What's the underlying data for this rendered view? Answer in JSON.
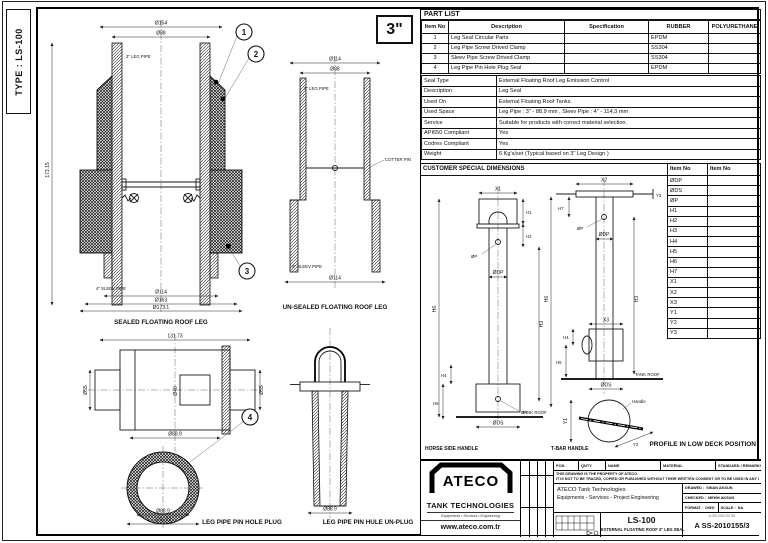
{
  "sheet": {
    "type_label": "TYPE : LS-100",
    "size_badge": "3\""
  },
  "part_list": {
    "title": "PART LIST",
    "headers": [
      "Item No",
      "Description",
      "Specification",
      "RUBBER",
      "POLYURETHANE"
    ],
    "rows": [
      {
        "no": "1",
        "desc": "Leg Seal Circular Parts",
        "spec": "",
        "rubber": "EPDM",
        "poly": ""
      },
      {
        "no": "2",
        "desc": "Leg Pipe Screw Drived Clamp",
        "spec": "",
        "rubber": "SS304",
        "poly": ""
      },
      {
        "no": "3",
        "desc": "Sleev Pipe Screw Drived Clamp",
        "spec": "",
        "rubber": "SS304",
        "poly": ""
      },
      {
        "no": "4",
        "desc": "Leg Pipe Pin Hole Plug Seal",
        "spec": "",
        "rubber": "EPDM",
        "poly": ""
      }
    ]
  },
  "seal_info": [
    {
      "label": "Seal Type",
      "value": "External Floating Roof Leg Emission Control"
    },
    {
      "label": "Description",
      "value": "Leg Seal"
    },
    {
      "label": "Used On",
      "value": "External Floating Roof Tanks."
    },
    {
      "label": "Used Space",
      "value": "Leg Pipe : 3\" - 88,9 mm , Sleev Pipe : 4\" - 114,3 mm"
    },
    {
      "label": "Service",
      "value": "Suitable for products with correct material selection."
    },
    {
      "label": "API650 Compliant",
      "value": "Yes"
    },
    {
      "label": "Codres Compliant",
      "value": "Yes"
    },
    {
      "label": "Weight",
      "value": "6 Kg's/set (Typical based on 3\" Leg Design )"
    }
  ],
  "customer": {
    "title": "CUSTOMER SPECIAL DIMENSIONS",
    "header_left": "Item No",
    "header_right": "Item No",
    "rows": [
      "ØDP",
      "ØDS",
      "ØP",
      "H1",
      "H2",
      "H3",
      "H4",
      "H5",
      "H6",
      "H7",
      "X1",
      "X2",
      "X3",
      "Y1",
      "Y2",
      "Y3"
    ],
    "profile_note": "PROFILE IN LOW DECK POSITION",
    "caption_horse": "HORSE SIDE HANDLE",
    "caption_tbar": "T-BAR HANDLE",
    "labels": {
      "x1": "X1",
      "x2": "X2",
      "x3": "X3",
      "y1": "Y1",
      "y2": "Y2",
      "y3": "Y3",
      "h1": "H1",
      "h2": "H2",
      "h3": "H3",
      "h4": "H4",
      "h5": "H5",
      "h6": "H6",
      "h7": "H7",
      "op": "ØP",
      "odp": "ØDP",
      "ods": "ØDS",
      "tank_roof": "TANK ROOF",
      "handle": "Handle"
    }
  },
  "drawings": {
    "sealed": {
      "caption": "SEALED FLOATING ROOF LEG",
      "d154": "Ø154",
      "d88": "Ø88",
      "leg_pipe": "3\" LEG PIPE",
      "sleev_pipe": "4\" SLEEV PIPE",
      "d114": "Ø114",
      "d163": "Ø163",
      "d173": "Ø173.1",
      "h_total": "173.15"
    },
    "unsealed": {
      "caption": "UN-SEALED FLOATING ROOF LEG",
      "d114": "Ø114",
      "d88": "Ø88",
      "leg_pipe": "3\" LEG PIPE",
      "cotter": "COTTER PIN",
      "sleev_pipe": "4\" SLEEV PIPE",
      "d114b": "Ø114"
    },
    "plug": {
      "caption": "LEG PIPE PIN HOLE PLUG",
      "w": "131.73",
      "d55l": "Ø55",
      "d40": "Ø40",
      "d55r": "Ø55",
      "d889": "Ø88.9",
      "ring_d": "Ø88.9",
      "ring_w": "131.73"
    },
    "unplug": {
      "caption": "LEG PIPE PIN HULE UN-PLUG",
      "d889": "Ø88.9"
    },
    "balloon1": "1",
    "balloon2": "2",
    "balloon3": "3",
    "balloon4": "4"
  },
  "title_block": {
    "logo_name": "ATECO",
    "logo_sub": "TANK TECHNOLOGIES",
    "logo_tagline": "Equipments • Services • Engineering",
    "logo_url": "www.ateco.com.tr",
    "headers": [
      "POS.",
      "QNTY",
      "NAME",
      "MATERIAL",
      "STANDARD / REMARKS"
    ],
    "notice1": "THIS DRAWING IS THE PROPERTY OF ATECO.",
    "notice2": "IT IS NOT TO BE TRACED, COPIED OR PUBLISHED WITHOUT THEIR WRITTEN CONSENT OR TO BE USED IN ANY WAY.",
    "company1": "ATECO Tank Technologies",
    "company2": "Equipments - Services - Project Engineering",
    "drawed_label": "DRAWED :",
    "drawed": "SINAN AKSUN",
    "checked_label": "CHECKED :",
    "checked": "MEHM AKSUN",
    "format_label": "FORMAT :",
    "format": "DWG",
    "scale_label": "SCALE :",
    "scale": "NA",
    "stamp": "A-SS-2010 B7 55",
    "doc_title": "LS-100",
    "doc_subtitle": "EXTERNAL FLOATING ROOF 3\" LEG SEAL",
    "doc_no": "A SS-2010155/3"
  }
}
